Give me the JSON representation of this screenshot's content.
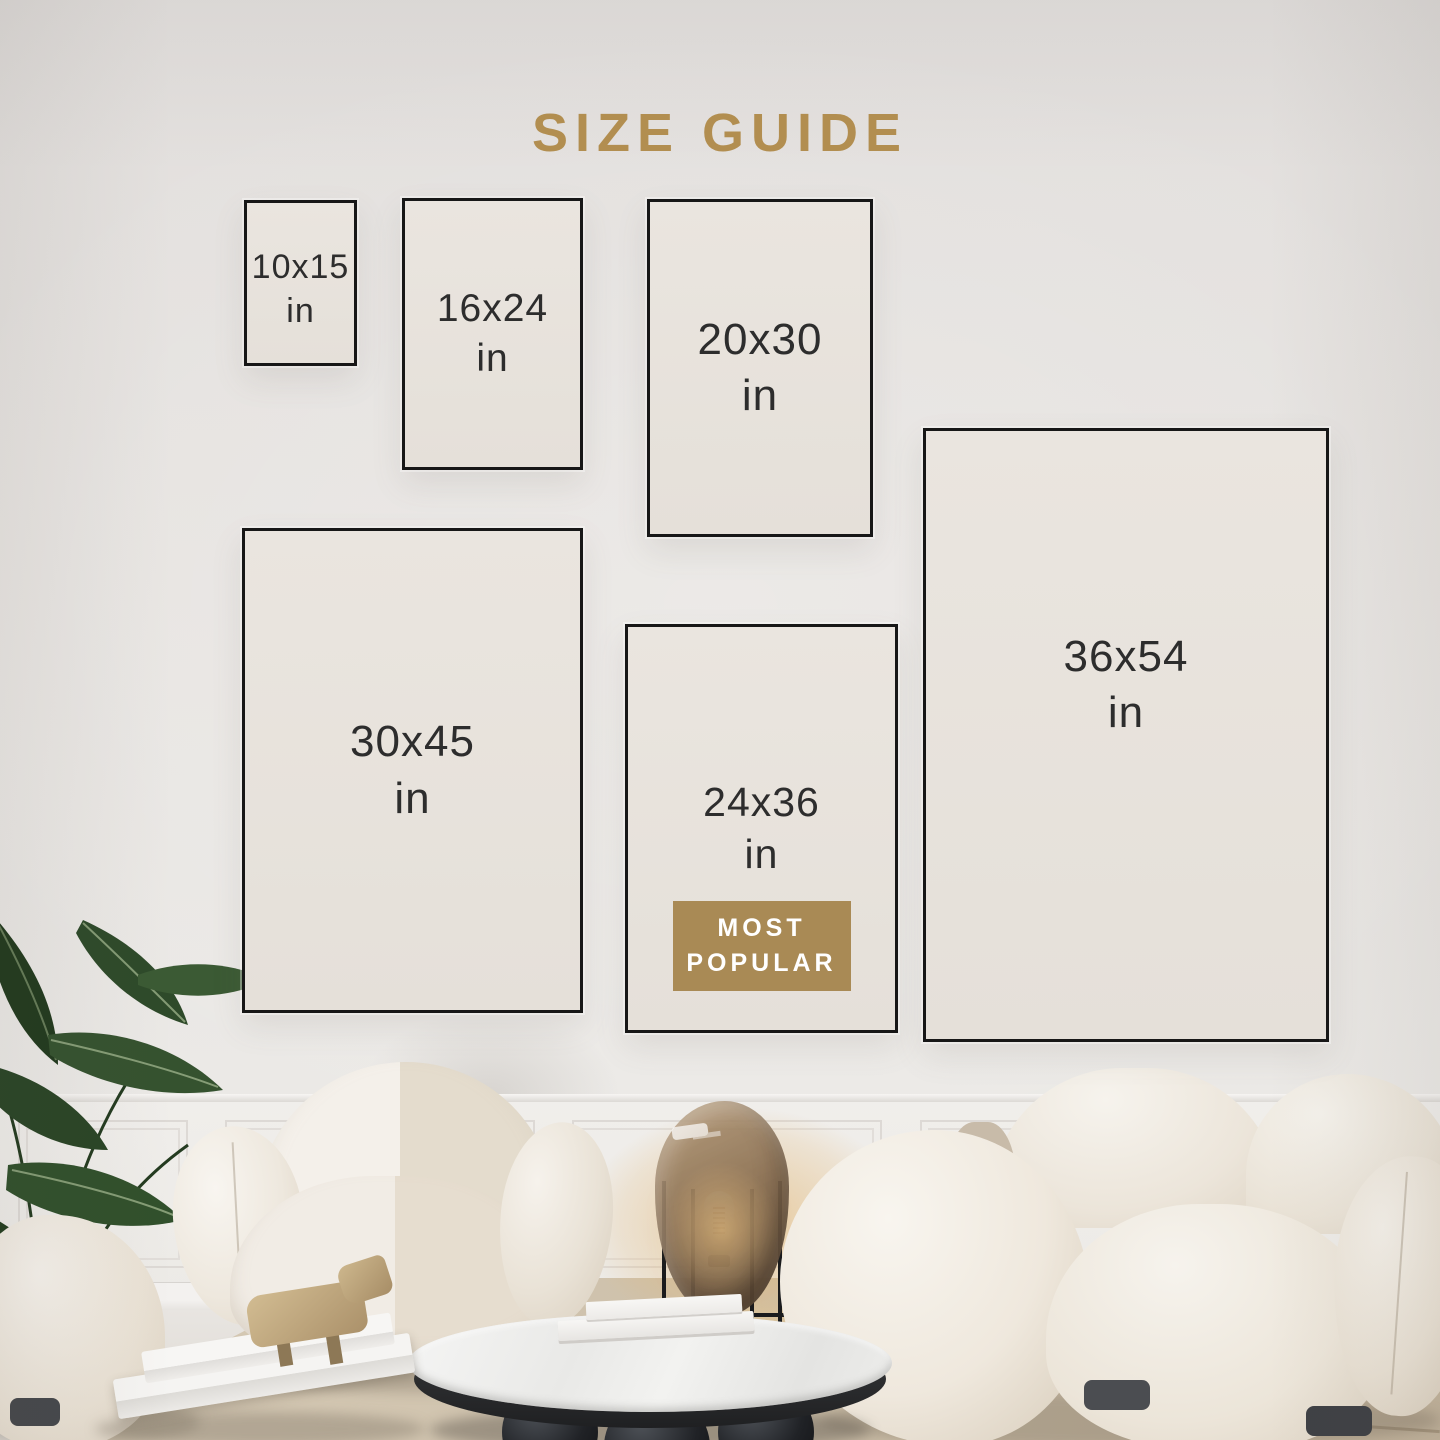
{
  "page": {
    "title": "SIZE GUIDE"
  },
  "palette": {
    "accent_gold": "#b28e50",
    "badge_gold": "#a98a55",
    "label_text": "#2d2d2d",
    "frame_border": "#171717",
    "frame_fill": "#e8e3dd"
  },
  "sizes": [
    {
      "id": "10x15",
      "label": "10x15",
      "unit": "in",
      "most_popular": false
    },
    {
      "id": "16x24",
      "label": "16x24",
      "unit": "in",
      "most_popular": false
    },
    {
      "id": "20x30",
      "label": "20x30",
      "unit": "in",
      "most_popular": false
    },
    {
      "id": "36x54",
      "label": "36x54",
      "unit": "in",
      "most_popular": false
    },
    {
      "id": "30x45",
      "label": "30x45",
      "unit": "in",
      "most_popular": false
    },
    {
      "id": "24x36",
      "label": "24x36",
      "unit": "in",
      "most_popular": true
    }
  ],
  "badge": {
    "line1": "MOST",
    "line2": "POPULAR"
  }
}
